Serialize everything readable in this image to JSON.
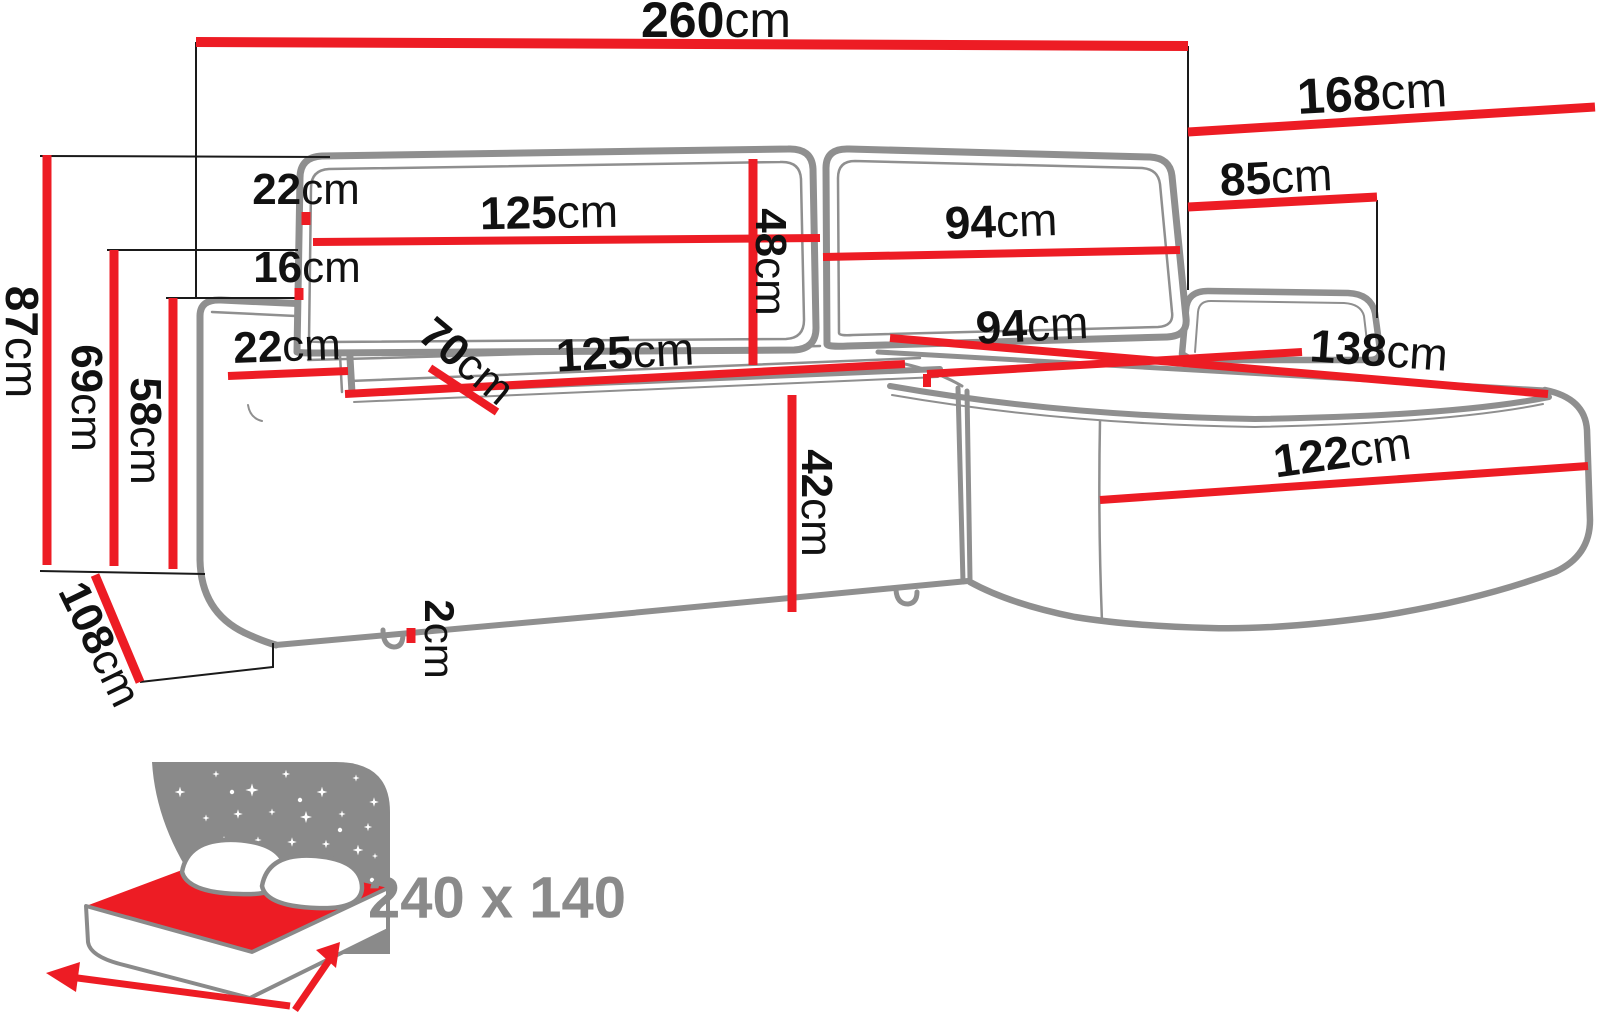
{
  "diagram": {
    "title": "corner-sofa-dimensions-diagram",
    "colors": {
      "dimension_red": "#ed1c24",
      "outline_gray": "#8f8f8f",
      "label_black": "#111111",
      "icon_gray": "#8a8a8a"
    },
    "dimensions": {
      "total_width": {
        "value": "260",
        "unit": "cm"
      },
      "chaise_depth": {
        "value": "168",
        "unit": "cm"
      },
      "chaise_width": {
        "value": "85",
        "unit": "cm"
      },
      "backrest_thickness": {
        "value": "22",
        "unit": "cm"
      },
      "backrest_left_width": {
        "value": "125",
        "unit": "cm"
      },
      "backrest_right_width": {
        "value": "94",
        "unit": "cm"
      },
      "backrest_gap": {
        "value": "16",
        "unit": "cm"
      },
      "armrest_width": {
        "value": "22",
        "unit": "cm"
      },
      "seat_depth": {
        "value": "70",
        "unit": "cm"
      },
      "seat_left_width": {
        "value": "125",
        "unit": "cm"
      },
      "seat_right_width": {
        "value": "94",
        "unit": "cm"
      },
      "chaise_length": {
        "value": "138",
        "unit": "cm"
      },
      "total_height": {
        "value": "87",
        "unit": "cm"
      },
      "armrest_height": {
        "value": "69",
        "unit": "cm"
      },
      "seat_back_height": {
        "value": "58",
        "unit": "cm"
      },
      "backrest_cushion_height": {
        "value": "48",
        "unit": "cm"
      },
      "seat_height": {
        "value": "42",
        "unit": "cm"
      },
      "total_depth": {
        "value": "108",
        "unit": "cm"
      },
      "chaise_front_width": {
        "value": "122",
        "unit": "cm"
      },
      "leg_height": {
        "value": "2",
        "unit": "cm"
      }
    },
    "sleeping_function": {
      "area_label": "240 x 140",
      "icon": "sofa-bed-night-icon"
    }
  }
}
